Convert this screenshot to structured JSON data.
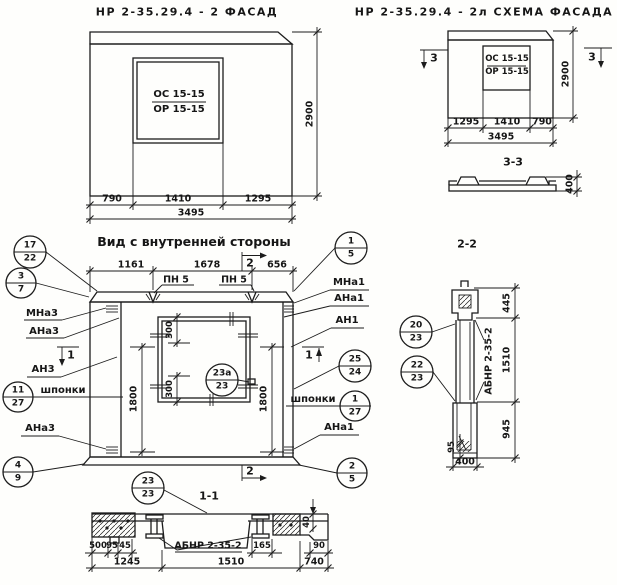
{
  "facade": {
    "title": "НР 2-35.29.4 - 2 ФАСАД",
    "win_top": "ОС 15-15",
    "win_bot": "ОР 15-15",
    "d_left": "790",
    "d_mid": "1410",
    "d_right": "1295",
    "d_total": "3495",
    "d_height": "2900"
  },
  "schema": {
    "title": "НР 2-35.29.4 - 2л СХЕМА ФАСАДА",
    "win_top": "ОС 15-15",
    "win_bot": "ОР 15-15",
    "d_left": "1295",
    "d_mid": "1410",
    "d_right": "790",
    "d_total": "3495",
    "d_height": "2900",
    "cut_left": "3",
    "cut_right": "3"
  },
  "s33": {
    "title": "3-3",
    "d400": "400"
  },
  "iv": {
    "title": "Вид с внутренней стороны",
    "d1": "1161",
    "d2": "1678",
    "d3": "656",
    "cut2_top": "2",
    "cut2_bot": "2",
    "cut1_left": "1",
    "cut1_right": "1",
    "pn5_l": "ПН 5",
    "pn5_r": "ПН 5",
    "d300_t": "300",
    "d300_b": "300",
    "d1800_l": "1800",
    "d1800_r": "1800",
    "c17_22": {
      "t": "17",
      "b": "22"
    },
    "c3_7": {
      "t": "3",
      "b": "7"
    },
    "mna3": "МНа3",
    "ana3": "АНа3",
    "an3": "АН3",
    "c11_27": {
      "t": "11",
      "b": "27"
    },
    "shponki_l": "шпонки",
    "ana3b": "АНа3",
    "c4_9": {
      "t": "4",
      "b": "9"
    },
    "c1_5": {
      "t": "1",
      "b": "5"
    },
    "mna1": "МНа1",
    "ana1": "АНа1",
    "an1": "АН1",
    "c25_24": {
      "t": "25",
      "b": "24"
    },
    "shponki_r": "шпонки",
    "c1_27": {
      "t": "1",
      "b": "27"
    },
    "ana1b": "АНа1",
    "c2_5": {
      "t": "2",
      "b": "5"
    },
    "c23a_23": {
      "t": "23а",
      "b": "23"
    }
  },
  "s22": {
    "title": "2-2",
    "c20_23": {
      "t": "20",
      "b": "23"
    },
    "c22_23": {
      "t": "22",
      "b": "23"
    },
    "label": "АБНР 2-35-2",
    "d445": "445",
    "d1510": "1510",
    "d945": "945",
    "d95": "95",
    "d400": "400"
  },
  "s11": {
    "title": "1-1",
    "c23_23": {
      "t": "23",
      "b": "23"
    },
    "label": "АБНР 2-35-2",
    "d500": "500",
    "d95": "95",
    "d45": "45",
    "d165": "165",
    "d90": "90",
    "d40": "40",
    "d1245": "1245",
    "d1510": "1510",
    "d740": "740"
  }
}
